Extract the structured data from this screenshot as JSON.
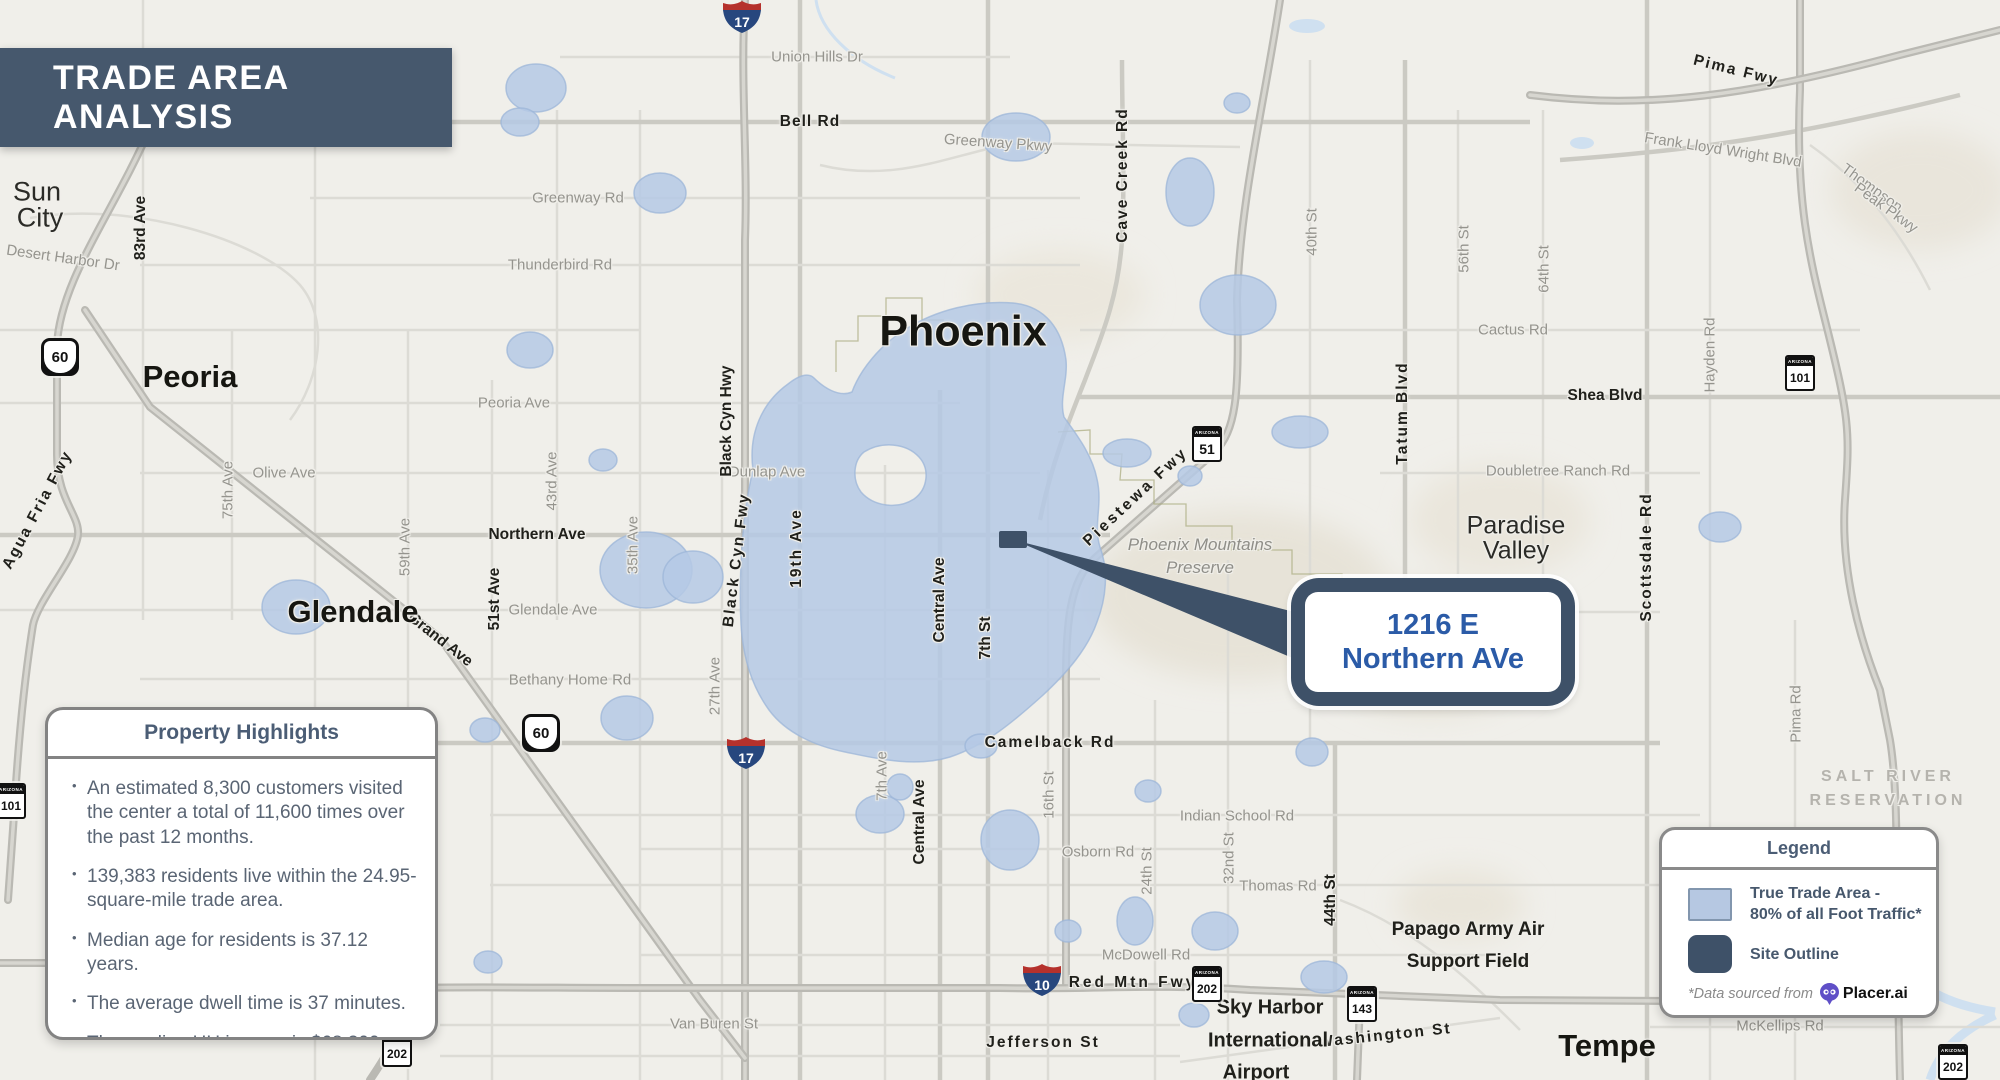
{
  "title": "TRADE AREA ANALYSIS",
  "callout": {
    "line1": "1216 E",
    "line2": "Northern AVe"
  },
  "property_highlights": {
    "title": "Property Highlights",
    "bullets": [
      "An estimated 8,300 customers visited the center a total of 11,600 times over the past 12 months.",
      "139,383 residents live within the 24.95-square-mile trade area.",
      "Median age for residents is 37.12 years.",
      "The average dwell time is 37 minutes.",
      "The median HH income is $68,300."
    ]
  },
  "legend": {
    "title": "Legend",
    "trade_area_label_1": "True Trade Area -",
    "trade_area_label_2": "80% of all Foot Traffic*",
    "site_outline_label": "Site Outline",
    "source_note": "*Data sourced from",
    "source_brand": "Placer.ai",
    "trade_area_color": "#b6c8e2",
    "site_outline_color": "#3e5168"
  },
  "map": {
    "cities": {
      "phoenix": "Phoenix",
      "peoria": "Peoria",
      "glendale": "Glendale",
      "tempe": "Tempe",
      "sun_city_1": "Sun",
      "sun_city_2": "City",
      "paradise_1": "Paradise",
      "paradise_2": "Valley"
    },
    "areas": {
      "preserve_1": "Phoenix Mountains",
      "preserve_2": "Preserve",
      "salt_river_1": "SALT RIVER",
      "salt_river_2": "RESERVATION",
      "papago_1": "Papago Army Air",
      "papago_2": "Support Field",
      "sky_1": "Sky Harbor",
      "sky_2": "International",
      "sky_3": "Airport"
    },
    "roads": {
      "union_hills": "Union Hills Dr",
      "bell": "Bell Rd",
      "greenway_pkwy": "Greenway Pkwy",
      "greenway_rd": "Greenway Rd",
      "thunderbird": "Thunderbird Rd",
      "cactus": "Cactus Rd",
      "peoria_ave": "Peoria Ave",
      "shea": "Shea Blvd",
      "olive": "Olive Ave",
      "dunlap": "Dunlap Ave",
      "doubletree": "Doubletree Ranch Rd",
      "northern": "Northern Ave",
      "glendale_ave": "Glendale Ave",
      "bethany": "Bethany Home Rd",
      "camelback": "Camelback Rd",
      "indian_school": "Indian School Rd",
      "osborn": "Osborn Rd",
      "thomas": "Thomas Rd",
      "mcdowell": "McDowell Rd",
      "red_mtn": "Red Mtn Fwy",
      "van_buren": "Van Buren St",
      "jefferson": "Jefferson St",
      "washington": "Washington St",
      "mckellips": "McKellips Rd",
      "frank_lloyd": "Frank Lloyd Wright Blvd",
      "thompson_1": "Thompson",
      "thompson_2": "Peak Pkwy",
      "pima_fwy": "Pima Fwy",
      "pima_rd": "Pima Rd",
      "desert_harbor": "Desert Harbor Dr",
      "agua_fria": "Agua Fria Fwy",
      "grand": "Grand Ave",
      "a83": "83rd Ave",
      "a75": "75th Ave",
      "a59": "59th Ave",
      "a51": "51st Ave",
      "a43": "43rd Ave",
      "a35": "35th Ave",
      "a27": "27th Ave",
      "a19": "19th Ave",
      "ave7": "7th Ave",
      "st7": "7th St",
      "st16": "16th St",
      "st24": "24th St",
      "st32": "32nd St",
      "st40": "40th St",
      "st44": "44th St",
      "st56": "56th St",
      "st64": "64th St",
      "central": "Central Ave",
      "cave_creek": "Cave Creek Rd",
      "black_cyn_hwy": "Black Cyn Hwy",
      "black_cyn_fwy": "Black Cyn Fwy",
      "piestewa": "Piestewa Fwy",
      "tatum": "Tatum Blvd",
      "scottsdale": "Scottsdale Rd",
      "hayden": "Hayden Rd"
    },
    "shields": {
      "az_label": "ARIZONA",
      "i17": "17",
      "i10": "10",
      "us60": "60",
      "az51": "51",
      "az101": "101",
      "az202": "202",
      "az143": "143"
    }
  },
  "colors": {
    "banner": "#46586d",
    "accent_dark": "#3e5168",
    "trade_area_fill": "#b6c8e2",
    "callout_text": "#2b5ba7"
  }
}
